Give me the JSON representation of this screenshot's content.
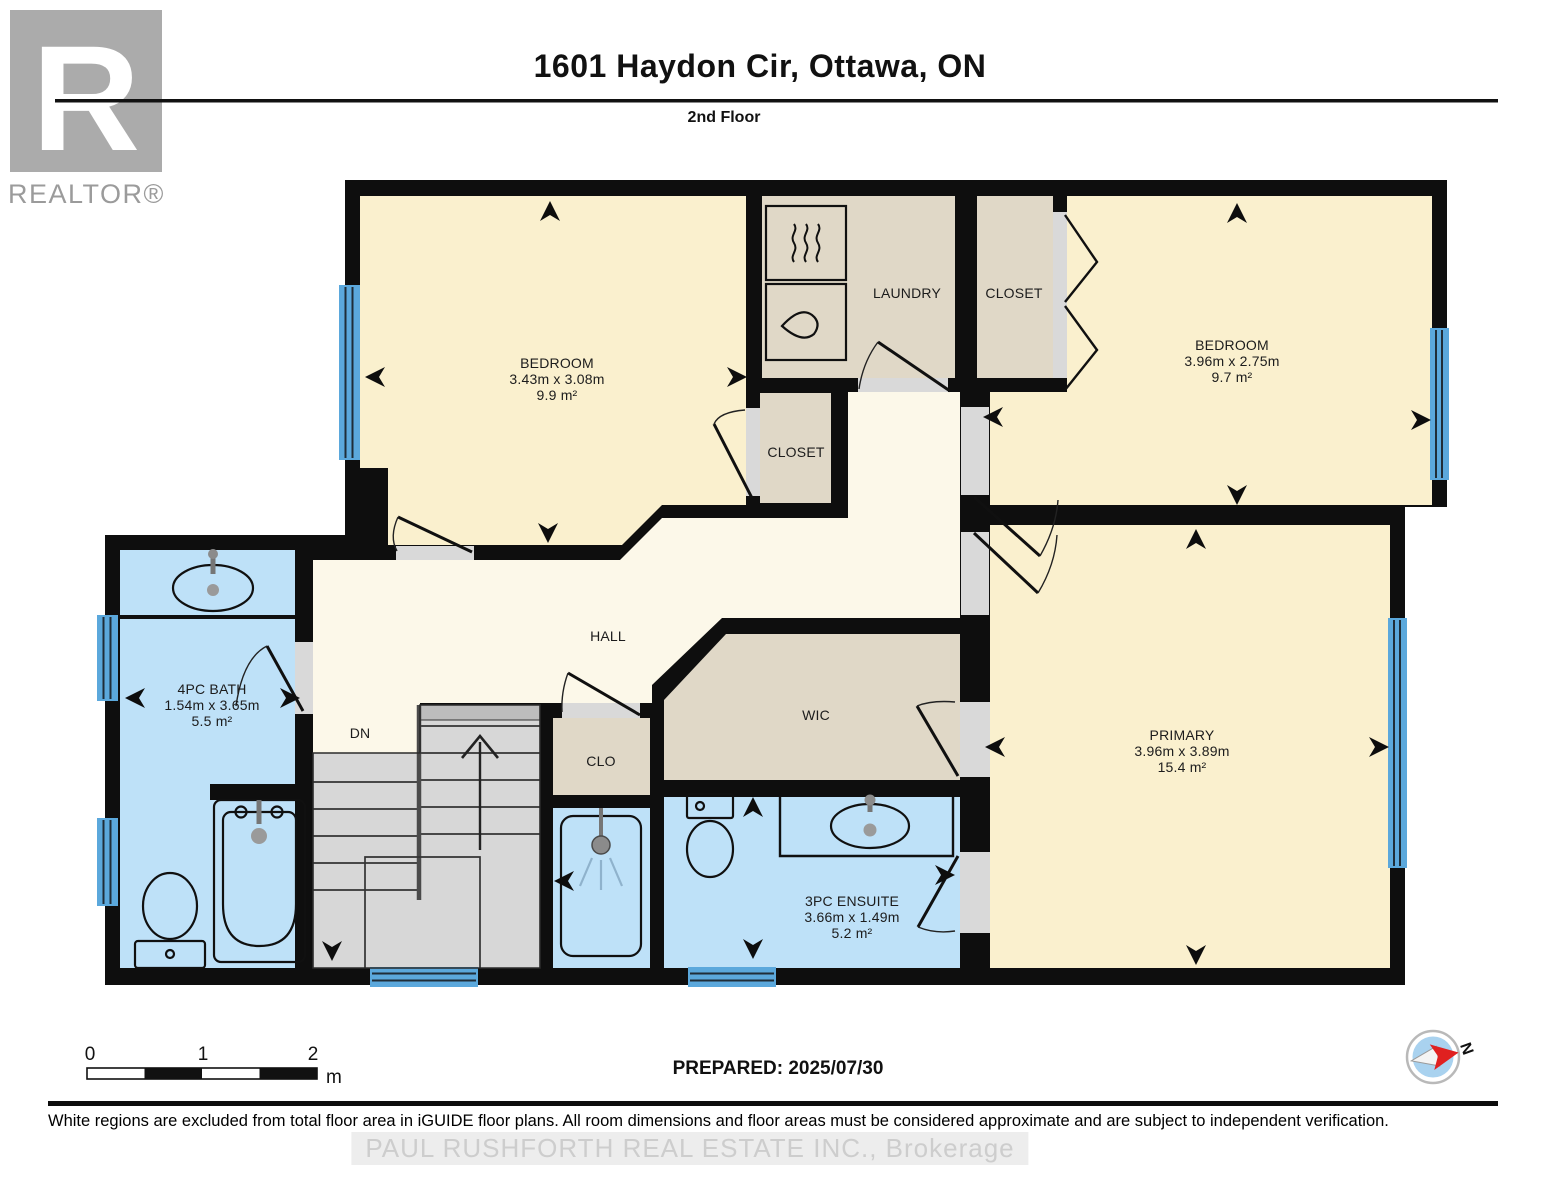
{
  "header": {
    "brand": "REALTOR®",
    "title": "1601 Haydon Cir, Ottawa, ON",
    "subtitle": "2nd Floor"
  },
  "plan": {
    "rooms": {
      "bedroom1": {
        "name": "BEDROOM",
        "dims": "3.43m x 3.08m",
        "area": "9.9 m²"
      },
      "bedroom2": {
        "name": "BEDROOM",
        "dims": "3.96m x 2.75m",
        "area": "9.7 m²"
      },
      "primary": {
        "name": "PRIMARY",
        "dims": "3.96m x 3.89m",
        "area": "15.4 m²"
      },
      "bath": {
        "name": "4PC BATH",
        "dims": "1.54m x 3.65m",
        "area": "5.5 m²"
      },
      "ensuite": {
        "name": "3PC ENSUITE",
        "dims": "3.66m x 1.49m",
        "area": "5.2 m²"
      },
      "laundry": {
        "name": "LAUNDRY"
      },
      "closet_top": {
        "name": "CLOSET"
      },
      "closet_mid": {
        "name": "CLOSET"
      },
      "clo": {
        "name": "CLO"
      },
      "wic": {
        "name": "WIC"
      },
      "hall": {
        "name": "HALL"
      },
      "stairs": {
        "label": "DN"
      }
    },
    "compass": {
      "north_label": "N"
    },
    "scale_bar": {
      "ticks": [
        "0",
        "1",
        "2"
      ],
      "unit": "m"
    }
  },
  "prepared_label": "PREPARED: 2025/07/30",
  "footer": {
    "disclaimer": "White regions are excluded from total floor area in iGUIDE floor plans. All room dimensions and floor areas must be considered approximate and are subject to independent verification.",
    "watermark": "PAUL RUSHFORTH REAL ESTATE INC.,  Brokerage"
  },
  "colors": {
    "wall": "#0E0E0E",
    "room_cream": "#FAF0CE",
    "hall_cream": "#FCF8E9",
    "closet_tan": "#E0D8C7",
    "wet_blue": "#BEE1F8",
    "stairs_gray": "#D7D7D7",
    "window_blue": "#5BA8DC",
    "logo_gray": "#ABABAB"
  }
}
